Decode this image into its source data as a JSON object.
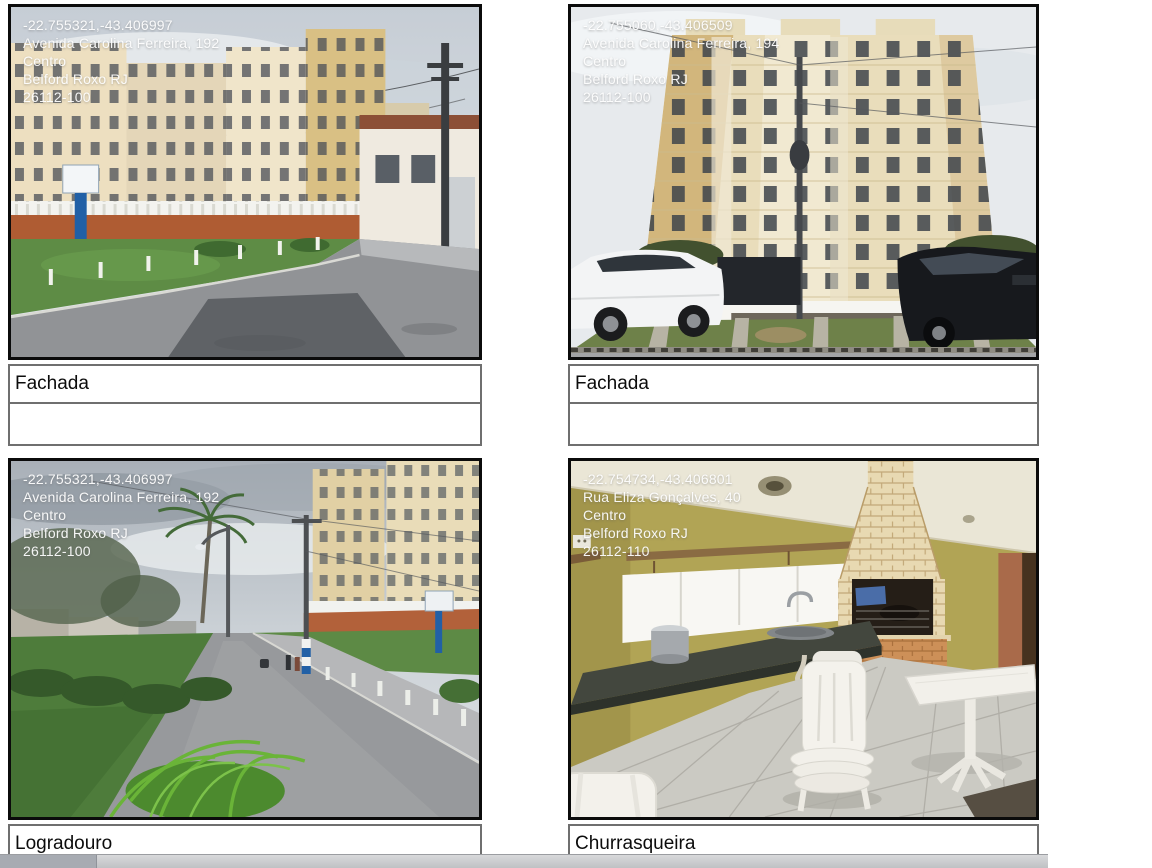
{
  "colors": {
    "page_background": "#ffffff",
    "photo_border": "#0b0b0b",
    "caption_border": "#6f6f6f",
    "caption_text": "#0c0c0c",
    "geotag_text": "#ffffff",
    "scrollbar_track": "#c6c8cb",
    "scrollbar_thumb": "#a7abb2"
  },
  "photos": [
    {
      "id": "fachada-1",
      "overlay_lines": [
        "-22.755321,-43.406997",
        "Avenida Carolina Ferreira, 192",
        "Centro",
        "Belford Roxo RJ",
        "26112-100"
      ],
      "caption": "Fachada",
      "notes": ""
    },
    {
      "id": "fachada-2",
      "overlay_lines": [
        "-22.755060,-43.406509",
        "Avenida Carolina Ferreira, 194",
        "Centro",
        "Belford Roxo RJ",
        "26112-100"
      ],
      "caption": "Fachada",
      "notes": ""
    },
    {
      "id": "logradouro",
      "overlay_lines": [
        "-22.755321,-43.406997",
        "Avenida Carolina Ferreira, 192",
        "Centro",
        "Belford Roxo RJ",
        "26112-100"
      ],
      "caption": "Logradouro",
      "notes": ""
    },
    {
      "id": "churrasqueira",
      "overlay_lines": [
        "-22.754734,-43.406801",
        "Rua Eliza Gonçalves, 40",
        "Centro",
        "Belford Roxo RJ",
        "26112-110"
      ],
      "caption": "Churrasqueira",
      "notes": ""
    }
  ]
}
